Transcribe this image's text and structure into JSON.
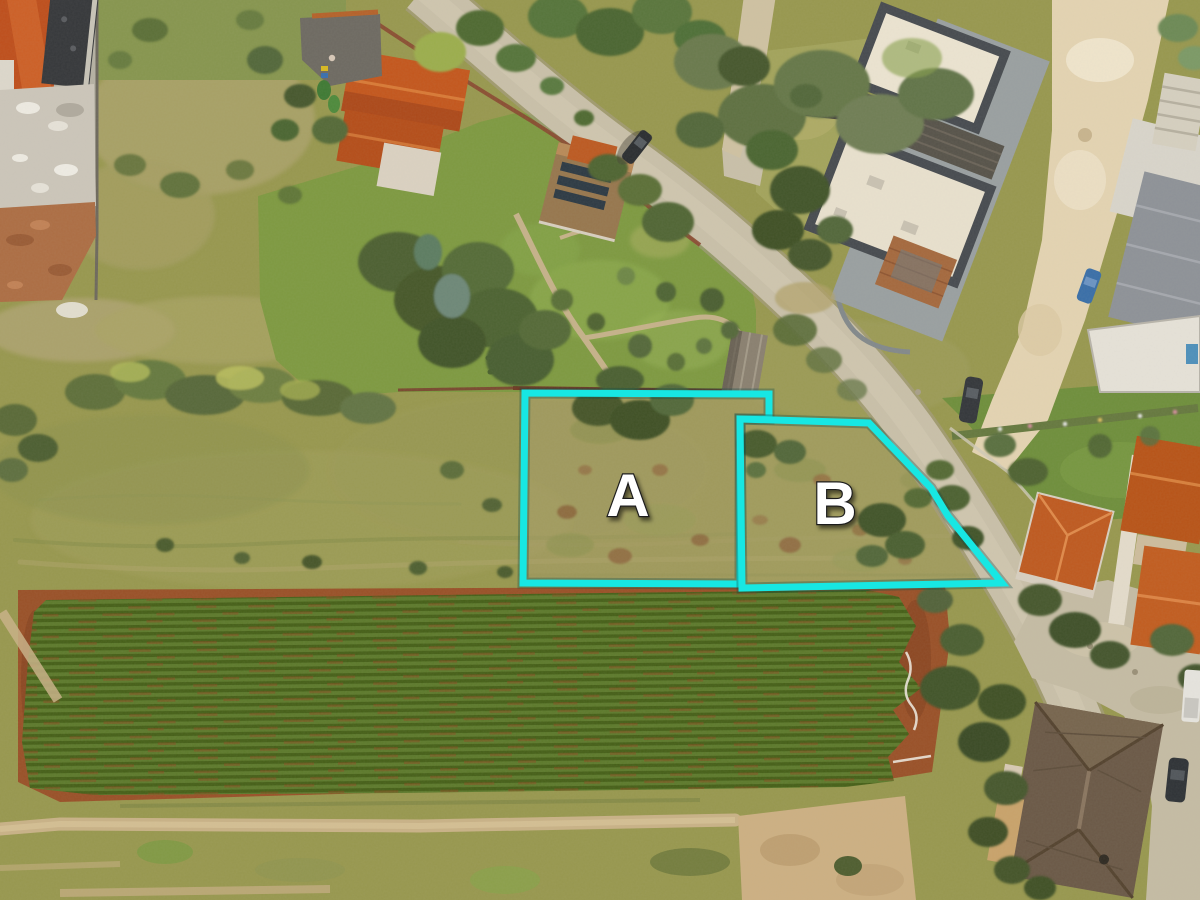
{
  "image": {
    "kind": "aerial drone photograph",
    "description": "Top-down aerial view of two vacant building parcels outlined in cyan and labeled A and B, set between a residential road with villas above and to the right, scrubland around them, and a large cultivated field with crop rows below.",
    "width_px": 1200,
    "height_px": 900
  },
  "overlay": {
    "accent_color": "#17e7e3",
    "outline_width": 7,
    "label_color": "#ffffff",
    "plots": [
      {
        "id": "a",
        "label": "A",
        "points": "525,393 769,394 769,419 740,419 740,584 523,583",
        "label_x": 627,
        "label_y": 516
      },
      {
        "id": "b",
        "label": "B",
        "points": "740,419 869,423 931,488 948,516 1002,583 742,588",
        "label_x": 834,
        "label_y": 524
      }
    ]
  },
  "scene": {
    "ground_features": [
      "scrubland",
      "cultivated field with crop rows",
      "farm track",
      "red-brown soil strips"
    ],
    "built_features": [
      "asphalt road",
      "white gravel driveway",
      "modern flat-roof villa complex",
      "orange tile-roof houses",
      "brown hip-roof house",
      "construction site",
      "garden shed",
      "stone garden paths"
    ],
    "vegetation": [
      "olive trees",
      "garden lawns",
      "flower hedge",
      "shrub rows"
    ],
    "vehicles": [
      "dark car driving on road",
      "dark car parked by driveway",
      "blue car at villa",
      "dark car by orange house",
      "white pickup at parking",
      "dark car at parking"
    ],
    "palette": {
      "scrub": "#98984f",
      "lawn": "#7d9a41",
      "crop_dark": "#466018",
      "crop_light": "#5d7a2c",
      "soil_red": "#9a4e26",
      "road": "#c9c0a9",
      "driveway_white": "#e6d6b4",
      "roof_orange": "#c2551e",
      "roof_cream": "#ece4d1",
      "roof_brown": "#6b5947",
      "roof_gray": "#8e9298"
    }
  }
}
